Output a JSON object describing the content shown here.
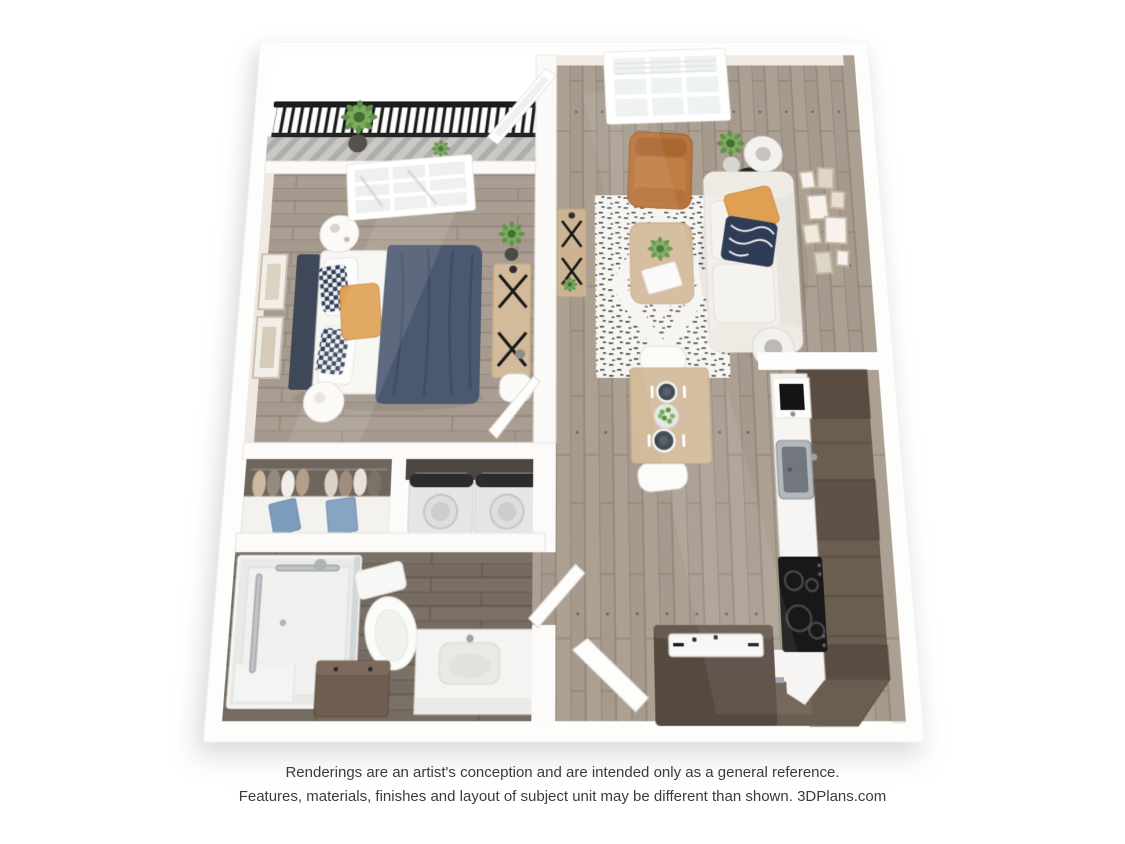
{
  "page": {
    "background": "#ffffff"
  },
  "disclaimer": {
    "line1": "Renderings are an artist's conception and are intended only as a general reference.",
    "line2": "Features, materials, finishes and layout of subject unit may be different than shown. 3DPlans.com"
  },
  "floorplan": {
    "type": "3d-apartment-floor-plan",
    "colors": {
      "wall": "#fdfdfc",
      "wall_face": "#eae5de",
      "wood_floor": "#a59a8d",
      "wood_floor_dark": "#766b61",
      "balcony_floor": "#c9c8c6",
      "railing": "#1c1c1c",
      "cabinet_brown": "#6b5d50",
      "island_brown": "#554940",
      "countertop": "#f6f5f3",
      "cooktop": "#181818",
      "appliance": "#e6e6e6",
      "sofa": "#f1efe9",
      "leather": "#b8743c",
      "accent_orange": "#dfa054",
      "navy": "#2e3c55",
      "headboard": "#3e4859",
      "blanket": "#4a5870",
      "rug": "#f7f5f1",
      "table_wood": "#d2ba9a",
      "plant": "#5f9148"
    }
  }
}
